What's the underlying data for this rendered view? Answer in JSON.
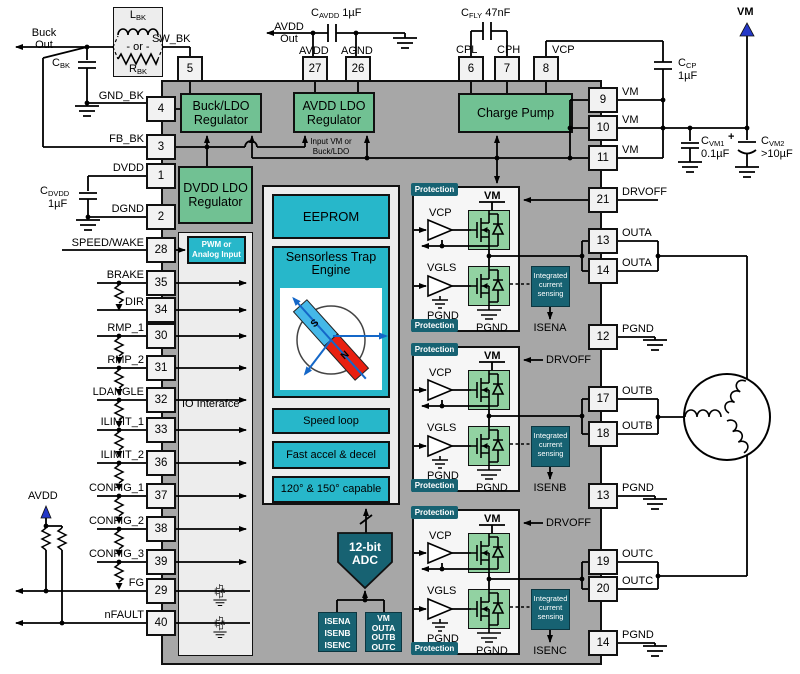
{
  "external": {
    "buck_out": "Buck Out",
    "l_bk": {
      "base": "L",
      "sub": "BK"
    },
    "or_label": "- or -",
    "r_bk": {
      "base": "R",
      "sub": "BK"
    },
    "c_bk": {
      "base": "C",
      "sub": "BK"
    },
    "c_dvdd": {
      "base": "C",
      "sub": "DVDD",
      "value": "1µF"
    },
    "avdd_out": "AVDD Out",
    "c_avdd": {
      "base": "C",
      "sub": "AVDD",
      "value": "1µF"
    },
    "c_fly": {
      "base": "C",
      "sub": "FLY",
      "value": "47nF"
    },
    "vm_top": "VM",
    "c_cp": {
      "base": "C",
      "sub": "CP",
      "value": "1µF"
    },
    "c_vm1": {
      "base": "C",
      "sub": "VM1",
      "value": "0.1µF"
    },
    "c_vm2": {
      "base": "C",
      "sub": "VM2",
      "value": ">10µF"
    },
    "plus_sign": "+",
    "avdd_pullup": "AVDD"
  },
  "pins": {
    "top": [
      {
        "num": "5",
        "label": "SW_BK"
      },
      {
        "num": "27",
        "label": "AVDD"
      },
      {
        "num": "26",
        "label": "AGND"
      },
      {
        "num": "6",
        "label": "CPL"
      },
      {
        "num": "7",
        "label": "CPH"
      },
      {
        "num": "8",
        "label": "VCP"
      }
    ],
    "left": [
      {
        "num": "4",
        "label": "GND_BK"
      },
      {
        "num": "3",
        "label": "FB_BK"
      },
      {
        "num": "1",
        "label": "DVDD"
      },
      {
        "num": "2",
        "label": "DGND"
      },
      {
        "num": "28",
        "label": "SPEED/WAKE"
      },
      {
        "num": "35",
        "label": "BRAKE"
      },
      {
        "num": "34",
        "label": "DIR"
      },
      {
        "num": "30",
        "label": "RMP_1"
      },
      {
        "num": "31",
        "label": "RMP_2"
      },
      {
        "num": "32",
        "label": "LDANGLE"
      },
      {
        "num": "33",
        "label": "ILIMIT_1"
      },
      {
        "num": "36",
        "label": "ILIMIT_2"
      },
      {
        "num": "37",
        "label": "CONFIG_1"
      },
      {
        "num": "38",
        "label": "CONFIG_2"
      },
      {
        "num": "39",
        "label": "CONFIG_3"
      },
      {
        "num": "29",
        "label": "FG"
      },
      {
        "num": "40",
        "label": "nFAULT"
      }
    ],
    "right": [
      {
        "num": "9",
        "label": "VM"
      },
      {
        "num": "10",
        "label": "VM"
      },
      {
        "num": "11",
        "label": "VM"
      },
      {
        "num": "21",
        "label": "DRVOFF"
      },
      {
        "num": "13",
        "label": "OUTA"
      },
      {
        "num": "14",
        "label": "OUTA"
      },
      {
        "num": "12",
        "label": "PGND"
      },
      {
        "num": "17",
        "label": "OUTB"
      },
      {
        "num": "18",
        "label": "OUTB"
      },
      {
        "num": "13",
        "label": "PGND"
      },
      {
        "num": "19",
        "label": "OUTC"
      },
      {
        "num": "20",
        "label": "OUTC"
      },
      {
        "num": "14",
        "label": "PGND"
      }
    ]
  },
  "chip": {
    "blocks": {
      "buck": "Buck/LDO Regulator",
      "avdd": "AVDD LDO Regulator",
      "charge_pump": "Charge Pump",
      "dvdd": "DVDD LDO Regulator",
      "input_note": "Input VM or Buck/LDO"
    },
    "io": {
      "title": "IO Interafce",
      "pwm": "PWM or Analog Input"
    },
    "engine": {
      "eeprom": "EEPROM",
      "trap": "Sensorless Trap Engine",
      "rotor_s": "S",
      "rotor_n": "N",
      "speed": "Speed loop",
      "accel": "Fast accel & decel",
      "capable": "120° & 150° capable"
    },
    "adc": {
      "label": "12-bit ADC",
      "in_left": "ISENA ISENB ISENC",
      "in_right": "VM OUTA OUTB OUTC"
    },
    "phases": [
      {
        "protection": "Protection",
        "vm": "VM",
        "vcp": "VCP",
        "vgls": "VGLS",
        "pgnd_left": "PGND",
        "pgnd_bottom": "PGND",
        "sense": "Integrated current sensing",
        "isen": "ISENA",
        "drvoff": "DRVOFF"
      },
      {
        "protection": "Protection",
        "vm": "VM",
        "vcp": "VCP",
        "vgls": "VGLS",
        "pgnd_left": "PGND",
        "pgnd_bottom": "PGND",
        "sense": "Integrated current sensing",
        "isen": "ISENB",
        "drvoff": "DRVOFF"
      },
      {
        "protection": "Protection",
        "vm": "VM",
        "vcp": "VCP",
        "vgls": "VGLS",
        "pgnd_left": "PGND",
        "pgnd_bottom": "PGND",
        "sense": "Integrated current sensing",
        "isen": "ISENC",
        "drvoff": "DRVOFF"
      }
    ]
  },
  "colors": {
    "chip_body": "#a7a7a7",
    "block_green": "#71c193",
    "block_cyan": "#27b7ca",
    "block_teal": "#176272",
    "fet_green": "#92d2a2",
    "accent_blue": "#2438c8",
    "rotor_blue": "#45b8e8",
    "rotor_red": "#e82010",
    "wire": "#000000"
  }
}
